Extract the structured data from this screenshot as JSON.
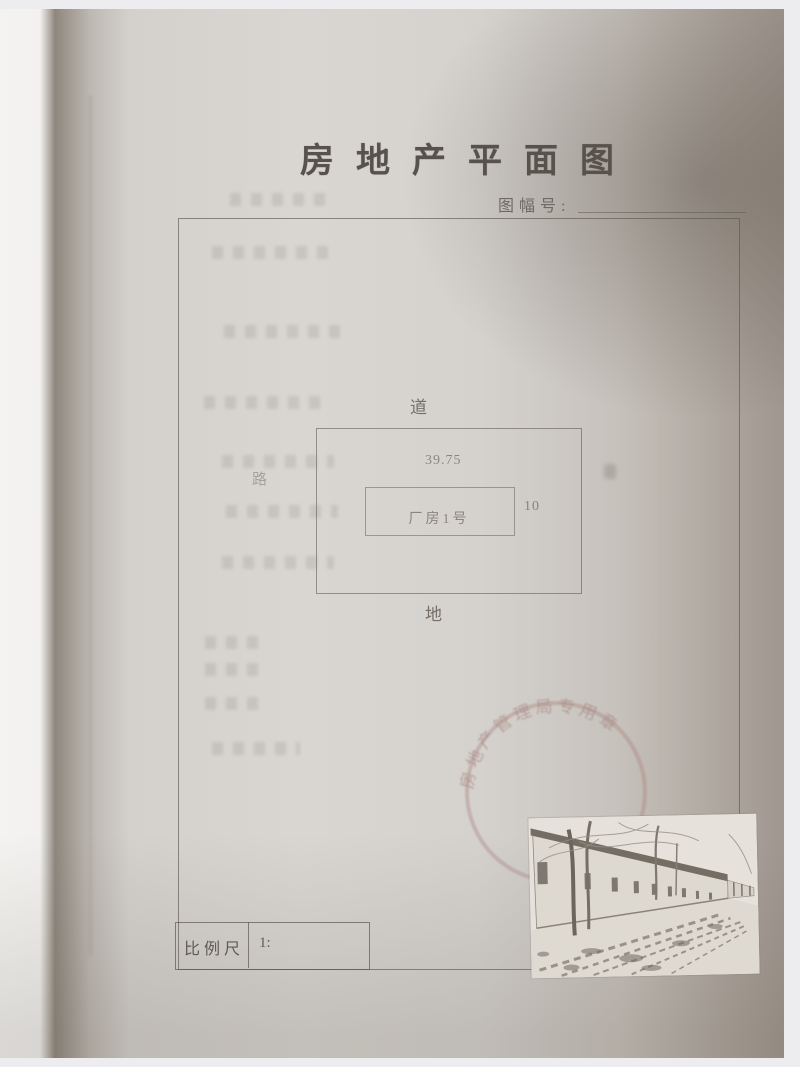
{
  "document": {
    "title": "房地产平面图",
    "sheet_number_label": "图幅号:",
    "sheet_number_value": ""
  },
  "plan": {
    "label_top": "道",
    "label_bottom": "地",
    "label_left": "路",
    "label_right": "",
    "dim_width": "39.75",
    "dim_height": "10",
    "building_name": "厂房1号"
  },
  "scale_bar": {
    "label": "比例尺",
    "value": "1:"
  },
  "stamp": {
    "arc_text": "房地产管理局专用章"
  },
  "colors": {
    "paper": "#d9d6d2",
    "ink": "#57534c",
    "line": "#5c574e",
    "stamp_red": "#a07c76"
  }
}
